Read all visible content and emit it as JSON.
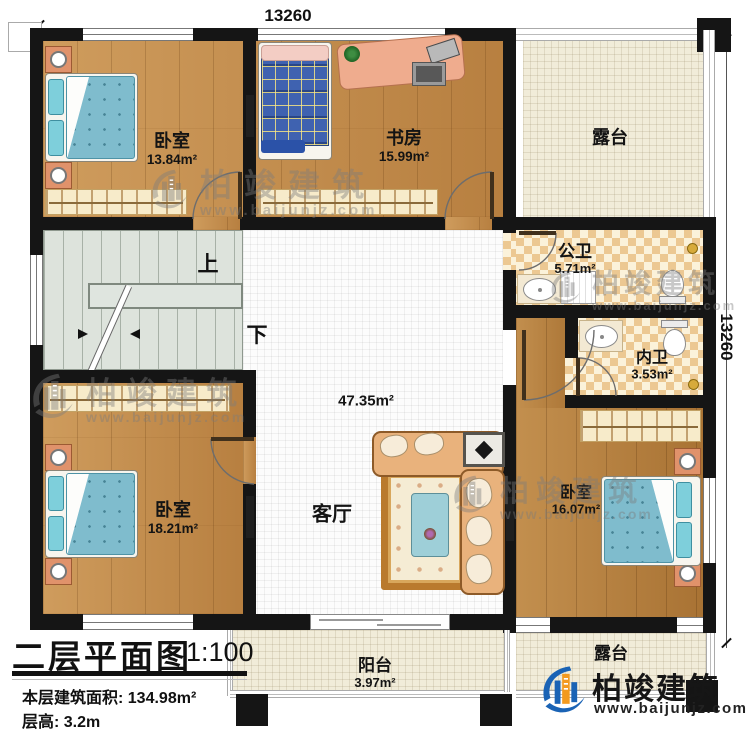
{
  "dimensions": {
    "top": "13260",
    "right": "13260"
  },
  "rooms": {
    "bedroom_top_left": {
      "name": "卧室",
      "area": "13.84m²"
    },
    "study": {
      "name": "书房",
      "area": "15.99m²"
    },
    "terrace_top": {
      "name": "露台"
    },
    "public_bath": {
      "name": "公卫",
      "area": "5.71m²"
    },
    "private_bath": {
      "name": "内卫",
      "area": "3.53m²"
    },
    "living_room": {
      "name": "客厅",
      "area": "47.35m²"
    },
    "bedroom_bottom_left": {
      "name": "卧室",
      "area": "18.21m²"
    },
    "bedroom_bottom_right": {
      "name": "卧室",
      "area": "16.07m²"
    },
    "balcony": {
      "name": "阳台",
      "area": "3.97m²"
    },
    "terrace_bottom": {
      "name": "露台"
    }
  },
  "stairs": {
    "up_label": "上",
    "down_label": "下"
  },
  "title_block": {
    "title": "二层平面图",
    "scale": "1:100",
    "area_line": "本层建筑面积: 134.98m²",
    "height_line": "层高: 3.2m"
  },
  "watermark": {
    "brand": "柏竣建筑",
    "url": "www.baijunjz.com"
  },
  "logo": {
    "brand": "柏竣建筑",
    "url": "www.baijunjz.com"
  }
}
